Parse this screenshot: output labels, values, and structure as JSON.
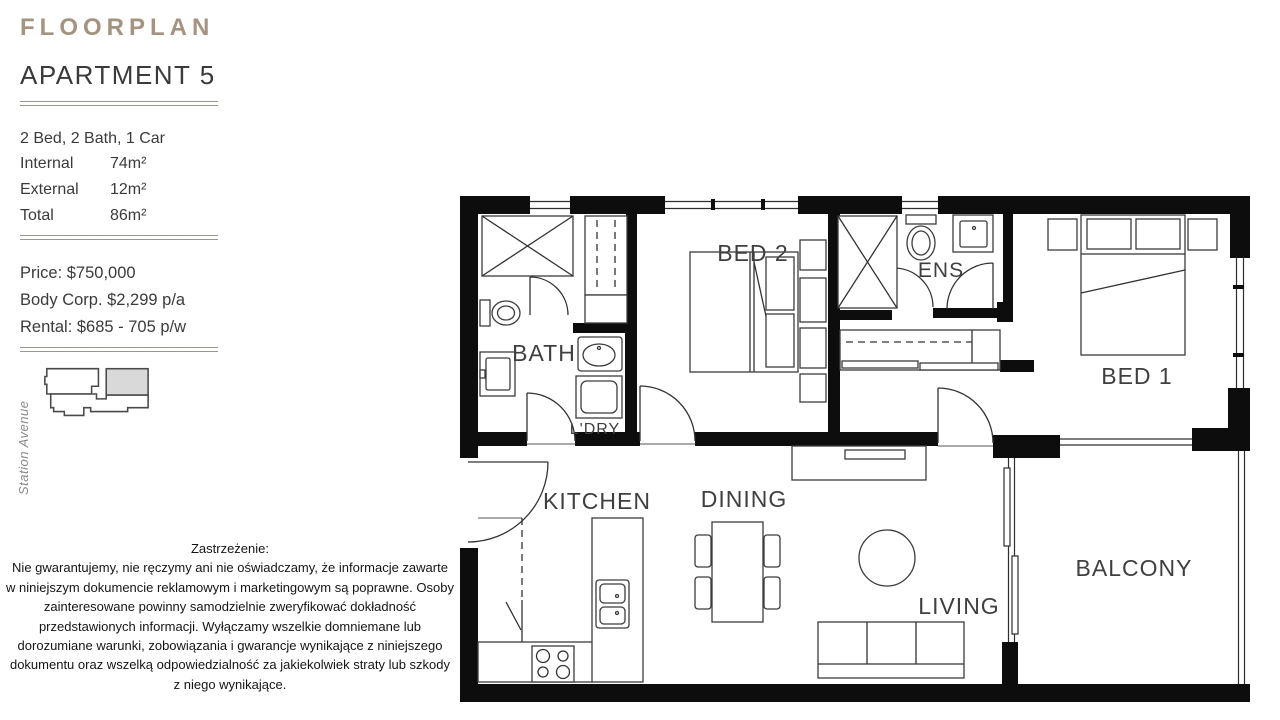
{
  "sidebar": {
    "eyebrow": "FLOORPLAN",
    "title": "APARTMENT 5",
    "config": "2 Bed, 2 Bath, 1 Car",
    "areas": [
      {
        "label": "Internal",
        "value": "74m²"
      },
      {
        "label": "External",
        "value": "12m²"
      },
      {
        "label": "Total",
        "value": "86m²"
      }
    ],
    "pricing": [
      "Price: $750,000",
      "Body Corp. $2,299 p/a",
      "Rental: $685 - 705 p/w"
    ],
    "street_label": "Station Avenue"
  },
  "disclaimer": {
    "title": "Zastrzeżenie:",
    "body": "Nie gwarantujemy, nie ręczymy ani nie oświadczamy, że informacje zawarte w niniejszym dokumencie reklamowym i marketingowym są poprawne. Osoby zainteresowane powinny samodzielnie zweryfikować dokładność przedstawionych informacji. Wyłączamy wszelkie domniemane lub dorozumiane warunki, zobowiązania i gwarancje wynikające z niniejszego dokumentu oraz wszelką odpowiedzialność za jakiekolwiek straty lub szkody z niego wynikające."
  },
  "floorplan": {
    "rooms": [
      {
        "id": "bed2",
        "label": "BED 2"
      },
      {
        "id": "ens",
        "label": "ENS"
      },
      {
        "id": "bed1",
        "label": "BED 1"
      },
      {
        "id": "bath",
        "label": "BATH"
      },
      {
        "id": "ldry",
        "label": "L'DRY"
      },
      {
        "id": "kitchen",
        "label": "KITCHEN"
      },
      {
        "id": "dining",
        "label": "DINING"
      },
      {
        "id": "living",
        "label": "LIVING"
      },
      {
        "id": "balcony",
        "label": "BALCONY"
      }
    ]
  },
  "colors": {
    "accent": "#a5937e",
    "ink": "#3b3b3b",
    "wall": "#0d0d0d",
    "street_text": "#8a8a8a",
    "unit_highlight": "#d9d9d9"
  }
}
